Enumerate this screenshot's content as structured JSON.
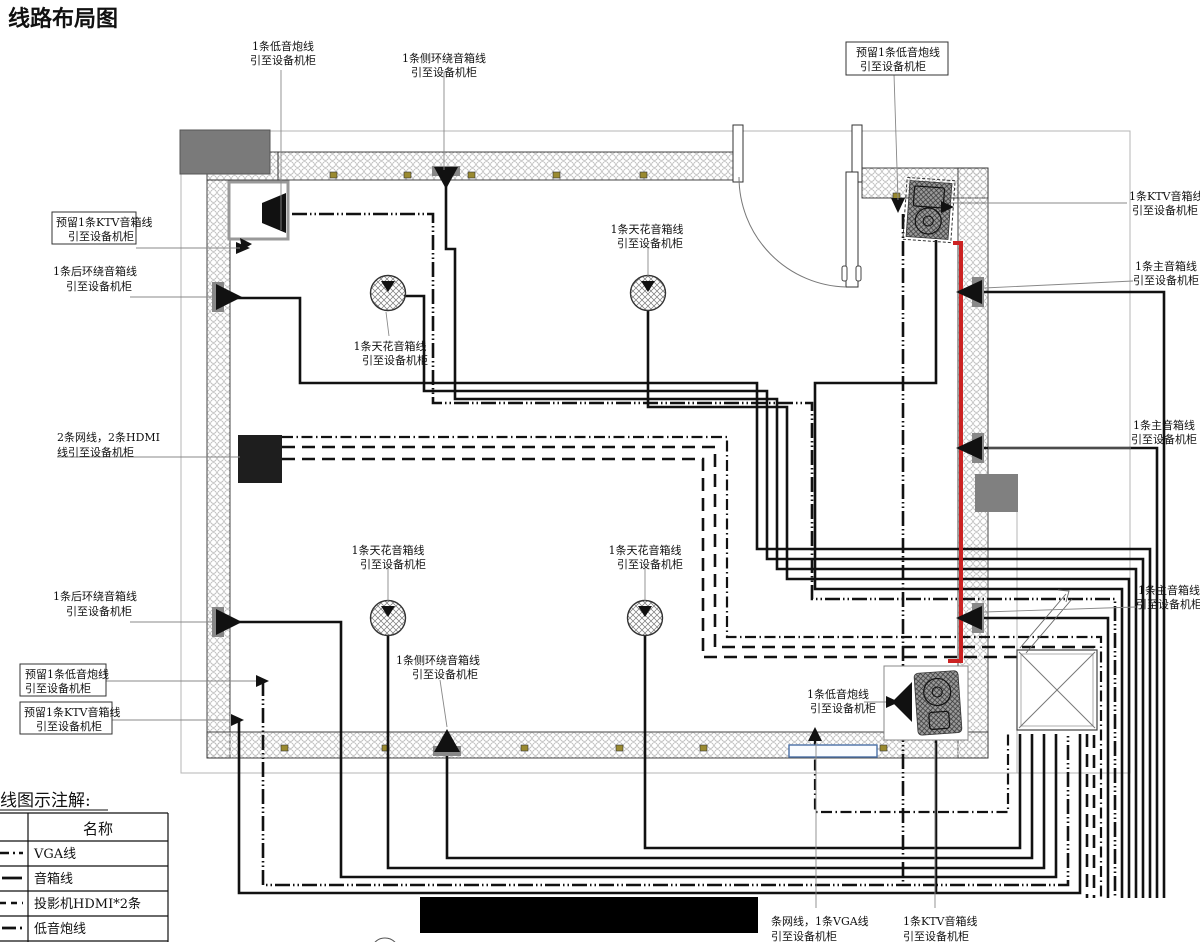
{
  "title": "线路布局图",
  "colors": {
    "title_red": "#e02020",
    "cable_red": "#cc2222"
  },
  "callouts": [
    {
      "line1": "1条低音炮线",
      "line2": "引至设备机柜",
      "boxed": false
    },
    {
      "line1": "1条侧环绕音箱线",
      "line2": "引至设备机柜",
      "boxed": false
    },
    {
      "line1": "预留1条低音炮线",
      "line2": "引至设备机柜",
      "boxed": true
    },
    {
      "line1": "1条KTV音箱线",
      "line2": "引至设备机柜",
      "boxed": false
    },
    {
      "line1": "1条主音箱线",
      "line2": "引至设备机柜",
      "boxed": false
    },
    {
      "line1": "2条网线，2条HDMI",
      "line2": "线引至设备机柜",
      "boxed": false
    },
    {
      "line1": "1条天花音箱线",
      "line2": "引至设备机柜",
      "boxed": false
    },
    {
      "line1": "1条天花音箱线",
      "line2": "引至设备机柜",
      "boxed": false
    },
    {
      "line1": "1条后环绕音箱线",
      "line2": "引至设备机柜",
      "boxed": false
    },
    {
      "line1": "预留1条KTV音箱线",
      "line2": "引至设备机柜",
      "boxed": true
    },
    {
      "line1": "1条天花音箱线",
      "line2": "引至设备机柜",
      "boxed": false
    },
    {
      "line1": "1条天花音箱线",
      "line2": "引至设备机柜",
      "boxed": false
    },
    {
      "line1": "1条侧环绕音箱线",
      "line2": "引至设备机柜",
      "boxed": false
    },
    {
      "line1": "1条后环绕音箱线",
      "line2": "引至设备机柜",
      "boxed": false
    },
    {
      "line1": "预留1条低音炮线",
      "line2": "引至设备机柜",
      "boxed": true
    },
    {
      "line1": "预留1条KTV音箱线",
      "line2": "引至设备机柜",
      "boxed": true
    },
    {
      "line1": "1条低音炮线",
      "line2": "引至设备机柜",
      "boxed": false
    },
    {
      "line1": "1条主音箱线",
      "line2": "引至设备机柜",
      "boxed": false
    },
    {
      "line1": "1条主音箱线",
      "line2": "引至设备机柜",
      "boxed": false
    },
    {
      "line1": "条网线，1条VGA线",
      "line2": "引至设备机柜",
      "boxed": false
    },
    {
      "line1": "1条KTV音箱线",
      "line2": "引至设备机柜",
      "boxed": false
    }
  ],
  "legend": {
    "title": "线图示注解:",
    "name_header": "名称",
    "rows": [
      {
        "name": "VGA线"
      },
      {
        "name": "音箱线"
      },
      {
        "name": "投影机HDMI*2条"
      },
      {
        "name": "低音炮线"
      }
    ]
  }
}
